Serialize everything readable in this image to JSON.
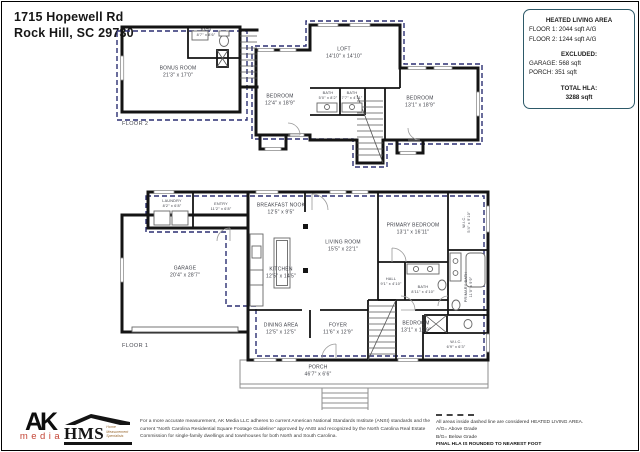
{
  "page": {
    "address_line1": "1715 Hopewell Rd",
    "address_line2": "Rock Hill, SC  29730"
  },
  "info_box": {
    "title": "HEATED LIVING AREA",
    "floor1_line": "FLOOR 1: 2044 sqft  A/G",
    "floor2_line": "FLOOR 2: 1244 sqft  A/G",
    "excluded_title": "EXCLUDED:",
    "garage_line": "GARAGE: 568 sqft",
    "porch_line": "PORCH: 351 sqft",
    "total_title": "TOTAL HLA:",
    "total_value": "3288 sqft"
  },
  "floor2": {
    "label": "FLOOR 2",
    "rooms": [
      {
        "name": "BONUS ROOM",
        "dims": "21'3\" x 17'0\""
      },
      {
        "name": "BATH",
        "dims": "8'7\" x 8'6\""
      },
      {
        "name": "LOFT",
        "dims": "14'10\" x 14'10\""
      },
      {
        "name": "BEDROOM",
        "dims": "12'4\" x 18'9\""
      },
      {
        "name": "BATH",
        "dims": "5'0\" x 8'2\""
      },
      {
        "name": "BATH",
        "dims": "7'7\" x 4'11\""
      },
      {
        "name": "BEDROOM",
        "dims": "13'1\" x 18'9\""
      }
    ]
  },
  "floor1": {
    "label": "FLOOR 1",
    "rooms": [
      {
        "name": "LAUNDRY",
        "dims": "8'2\" x 6'8\""
      },
      {
        "name": "ENTRY",
        "dims": "11'2\" x 6'8\""
      },
      {
        "name": "BREAKFAST NOOK",
        "dims": "12'5\" x 9'5\""
      },
      {
        "name": "LIVING ROOM",
        "dims": "15'5\" x 22'1\""
      },
      {
        "name": "PRIMARY BEDROOM",
        "dims": "13'1\" x 16'11\""
      },
      {
        "name": "W.I.C.",
        "dims": "5'4\" x 9'10\""
      },
      {
        "name": "GARAGE",
        "dims": "20'4\" x 28'7\""
      },
      {
        "name": "KITCHEN",
        "dims": "12'5\" x 14'5\""
      },
      {
        "name": "HALL",
        "dims": "9'1\" x 4'10\""
      },
      {
        "name": "BATH",
        "dims": "8'11\" x 4'10\""
      },
      {
        "name": "PRIMARY BATH",
        "dims": "11'0\" x 9'9\""
      },
      {
        "name": "DINING AREA",
        "dims": "12'5\" x 12'5\""
      },
      {
        "name": "FOYER",
        "dims": "11'6\" x 12'9\""
      },
      {
        "name": "BEDROOM",
        "dims": "13'1\" x 12'9\""
      },
      {
        "name": "W.I.C.",
        "dims": "6'9\" x 6'3\""
      },
      {
        "name": "PORCH",
        "dims": "46'7\" x 6'6\""
      }
    ]
  },
  "footer": {
    "ak_logo_top": "AK",
    "ak_logo_bottom": "media",
    "hms_letters": "HMS",
    "hms_tagline1": "Home",
    "hms_tagline2": "Measurement",
    "hms_tagline3": "Specialists",
    "disclaimer": "For a more accurate measurement, AK Media LLC adheres to current American National Standards Institute (ANSI) standards and the current \"North Carolina Residential Square Footage Guideline\" approved by ANSI and recognized by the North Carolina Real Estate Commission for single-family dwellings and townhouses for both North and South Carolina.",
    "legend_line1": "All areas inside dashed line are considered HEATED LIVING AREA.",
    "legend_line2": "A/G= Above Grade",
    "legend_line3": "B/G= Below Grade",
    "legend_line4": "FINAL HLA IS ROUNDED TO NEAREST FOOT"
  },
  "colors": {
    "heated_dashed_line": "#2b2f72",
    "info_box_border": "#2d5968",
    "ak_media_orange": "#c44536",
    "hms_brown": "#9a6a32",
    "walls": "#141414"
  }
}
